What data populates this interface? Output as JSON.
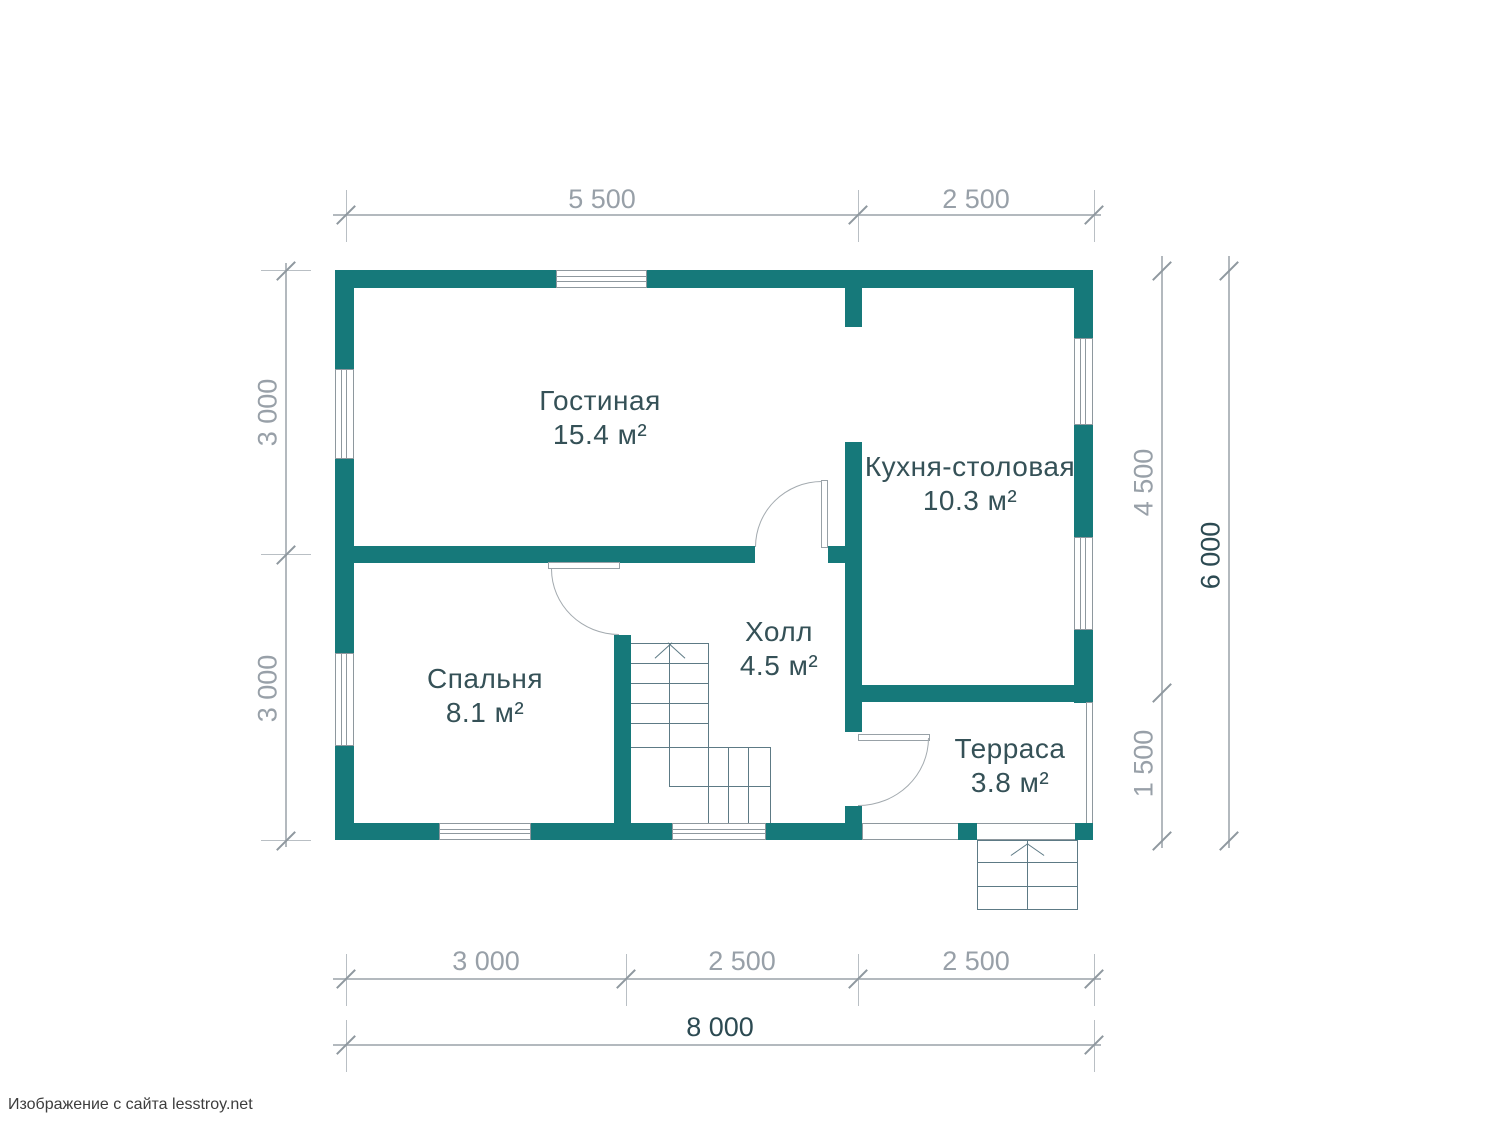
{
  "footer": {
    "text": "Изображение с сайта lesstroy.net"
  },
  "palette": {
    "wall": "#16797a",
    "room_label": "#355157",
    "dim_text": "#98a0a8",
    "dim_text_dark": "#2c4a52",
    "thin_line": "#5d7a85",
    "dim_line": "#b3b9be"
  },
  "rooms": [
    {
      "name": "Гостиная",
      "area": "15.4 м²"
    },
    {
      "name": "Кухня-столовая",
      "area": "10.3 м²"
    },
    {
      "name": "Спальня",
      "area": "8.1 м²"
    },
    {
      "name": "Холл",
      "area": "4.5 м²"
    },
    {
      "name": "Терраса",
      "area": "3.8 м²"
    }
  ],
  "dims": {
    "top": [
      "5 500",
      "2 500"
    ],
    "left": [
      "3 000",
      "3 000"
    ],
    "right": [
      "4 500",
      "1 500"
    ],
    "right_total": "6 000",
    "bottom": [
      "3 000",
      "2 500",
      "2 500"
    ],
    "bottom_total": "8 000"
  }
}
